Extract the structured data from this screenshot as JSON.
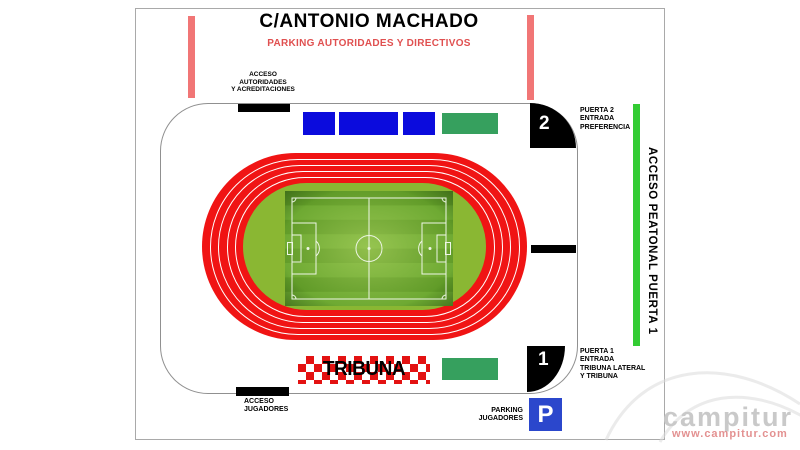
{
  "title": "C/ANTONIO MACHADO",
  "subtitle": "PARKING AUTORIDADES Y DIRECTIVOS",
  "accesses": {
    "autoridades": "ACCESO\nAUTORIDADES\nY ACREDITACIONES",
    "jugadores": "ACCESO\nJUGADORES"
  },
  "gates": {
    "puerta2": {
      "number": "2",
      "label": "PUERTA 2\nENTRADA\nPREFERENCIA"
    },
    "puerta1": {
      "number": "1",
      "label": "PUERTA 1\nENTRADA\nTRIBUNA LATERAL\nY TRIBUNA"
    }
  },
  "pedestrian_access_label": "ACCESO PEATONAL PUERTA 1",
  "tribuna_label": "TRIBUNA",
  "parking_jugadores": {
    "label": "PARKING\nJUGADORES",
    "symbol": "P"
  },
  "watermark": {
    "name": "campitur",
    "url": "www.campitur.com"
  },
  "colors": {
    "track_red": "#f01414",
    "infield_green": "#8ab733",
    "pitch_green": "#5f9a27",
    "stand_blue": "#0b0bdd",
    "stand_green": "#36a05e",
    "gate_black": "#000000",
    "pedestrian_green": "#33cc33",
    "parking_blue": "#2b47cc",
    "accent_pink": "#f17676",
    "subtitle_red": "#e05050",
    "checker_red": "#e31212"
  }
}
